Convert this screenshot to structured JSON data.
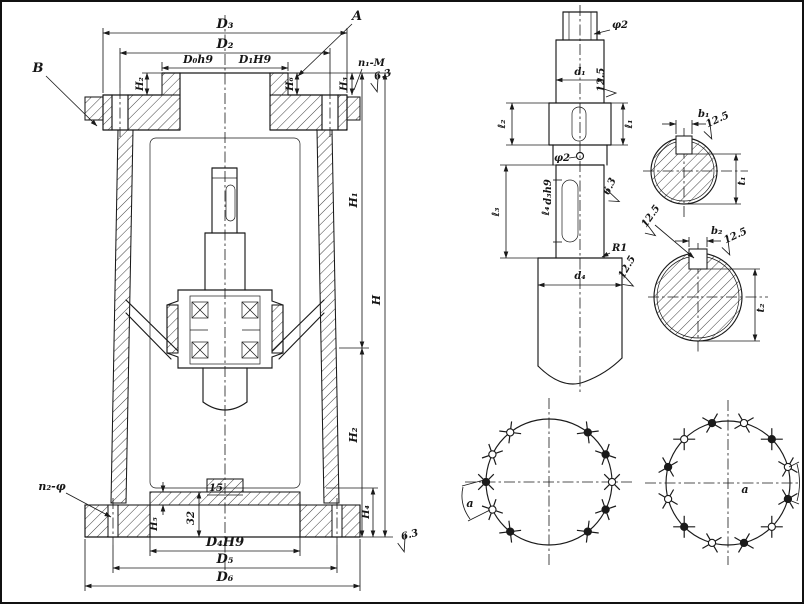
{
  "main": {
    "view_a": "A",
    "view_b": "B",
    "D3": "D₃",
    "D2": "D₂",
    "D0h9": "D₀h9",
    "D1H9": "D₁H9",
    "H2_top": "H₂",
    "H6": "H₆",
    "H3": "H₃",
    "n1M": "n₁-M",
    "finish_top": "6.3",
    "H1": "H₁",
    "H": "H",
    "H2_bot": "H₂",
    "H4": "H₄",
    "finish_bottom": "6.3",
    "n2phi": "n₂-φ",
    "dim15": "15",
    "dim32": "32",
    "H5": "H₅",
    "D4H9": "D₄H9",
    "D5": "D₅",
    "D6": "D₆"
  },
  "shaft": {
    "phi2_top": "φ2",
    "d1": "d₁",
    "finish_d1": "12.5",
    "l1": "ℓ₁",
    "l2": "ℓ₂",
    "phi2_hole": "φ2",
    "d3h9": "d₃h9",
    "l3": "ℓ₃",
    "l4": "ℓ₄",
    "finish_mid": "6.3",
    "R1": "R1",
    "finish_d4": "12.5",
    "d4": "d₄"
  },
  "sec1": {
    "b1": "b₁",
    "finish": "12.5",
    "t1": "t₁"
  },
  "sec2": {
    "b2": "b₂",
    "finish": "12.5",
    "finish_kw": "12.5",
    "t2": "t₂"
  },
  "bolts": {
    "left": {
      "a": "a",
      "cx": 549,
      "cy": 482,
      "r": 63,
      "angles": [
        -52,
        -26,
        0,
        26,
        52,
        128,
        154,
        180,
        206,
        232
      ],
      "filled": [
        1,
        1,
        0,
        1,
        1,
        0,
        0,
        1,
        0,
        1
      ]
    },
    "right": {
      "a": "a",
      "cx": 728,
      "cy": 483,
      "r": 62,
      "angles": [
        15,
        45,
        75,
        105,
        135,
        165,
        195,
        225,
        255,
        285,
        315,
        345
      ],
      "filled": [
        0,
        1,
        0,
        1,
        0,
        1,
        0,
        1,
        0,
        1,
        0,
        1
      ]
    }
  }
}
